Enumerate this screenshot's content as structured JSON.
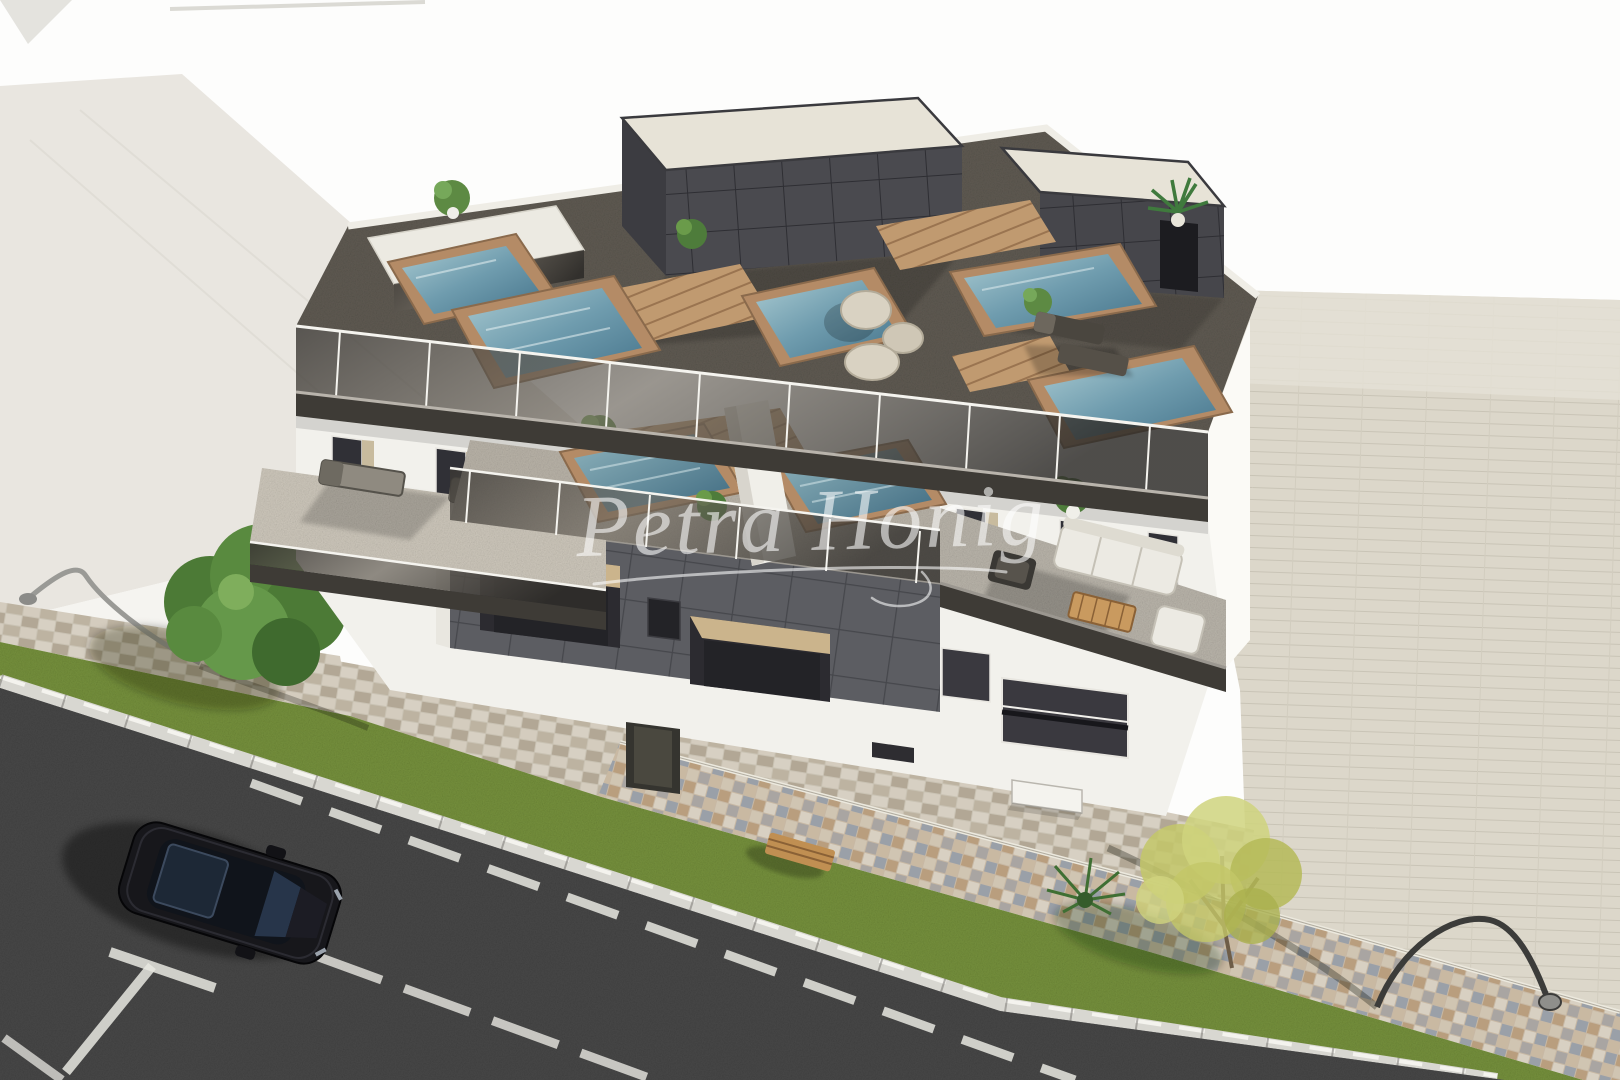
{
  "image": {
    "kind": "3D architectural exterior rendering",
    "view": "aerial oblique view of a modern apartment building with rooftop pools",
    "width_px": 1620,
    "height_px": 1080
  },
  "watermark": {
    "text": "Petra Honig",
    "color": "#ffffff",
    "opacity": 0.58,
    "underline": true
  },
  "palette": {
    "background": "#fdfdfc",
    "neighbor_building": "#e9e6e0",
    "building_white": "#f2f1ec",
    "dark_tile_facade": "#5c5d62",
    "penthouse_tile": "#47474c",
    "roof_deck": "#5f5a52",
    "fascia": "#3e3b36",
    "glass_railing": "#4b4742",
    "pool_water": "#6f9cae",
    "pool_wood_surround": "#b48b66",
    "terrace_floor": "#c0bab0",
    "paved_lot": "#dcd7ca",
    "mosaic_wall": "#c7b8a4",
    "cobble_path": "#c9c2b3",
    "grass": "#75903c",
    "curb": "#d8d7d1",
    "asphalt": "#474747",
    "road_marking": "#e8e7e1",
    "car_body": "#17171b",
    "tree_green": "#55823f",
    "tree_yellow": "#c2c468"
  },
  "scene": {
    "building": {
      "roof_pools": 5,
      "terrace_pools": 2,
      "penthouses": 3,
      "railing": "glass",
      "roof_furniture": [
        "sun-loungers",
        "round-poufs",
        "potted-plants",
        "palm-plant"
      ],
      "terrace_furniture": [
        "sun-loungers",
        "outdoor-sofa",
        "coffee-table",
        "armchair",
        "lounge-chair",
        "potted-plants"
      ],
      "facade": [
        "dark-tile-feature-block",
        "floor-to-ceiling-windows",
        "entrance-door",
        "ac-unit"
      ]
    },
    "street": {
      "vehicles": [
        "black-car"
      ],
      "markings": [
        "dashed-center-line",
        "parking-tee-mark",
        "corner-line"
      ],
      "furniture": [
        "street-lamp-left",
        "street-lamp-right",
        "wooden-bench"
      ],
      "vegetation": [
        "green-tree",
        "yellow-green-tree",
        "grass-strip",
        "shrub"
      ]
    },
    "surroundings": [
      "neighbor-building-left",
      "paved-lot-right",
      "mosaic-boundary-wall",
      "cobblestone-sidewalk"
    ]
  }
}
